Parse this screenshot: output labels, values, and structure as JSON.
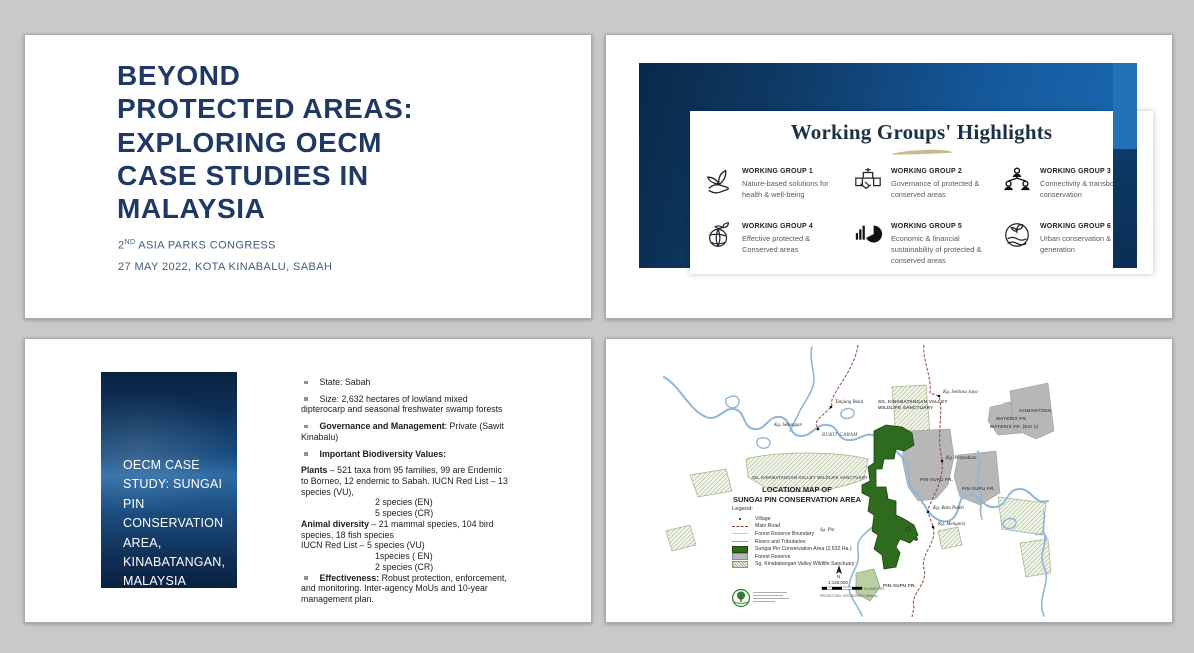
{
  "colors": {
    "canvas_bg": "#c9c9c9",
    "title_navy": "#1F3864",
    "subtitle_steel": "#3E5E7E",
    "frame_blue_dark": "#0a2948",
    "frame_blue_light": "#1a6cb4",
    "gold": "#C9BB8B",
    "map_green": "#2e6b1e",
    "map_gray": "#b7b7b7",
    "river_blue": "#8fb6d6",
    "road_brown": "#8a4a38"
  },
  "slide1": {
    "title": "BEYOND\nPROTECTED AREAS:\nEXPLORING OECM\nCASE STUDIES IN\nMALAYSIA",
    "congress_prefix": "2",
    "congress_sup": "ND",
    "congress_rest": " ASIA PARKS CONGRESS",
    "date_line": "27 MAY 2022, KOTA KINABALU, SABAH"
  },
  "slide2": {
    "title": "Working Groups' Highlights",
    "groups": [
      {
        "num": "WORKING GROUP 1",
        "desc": "Nature-based solutions for health & well-being",
        "icon": "hand-seedling-icon"
      },
      {
        "num": "WORKING GROUP 2",
        "desc": "Governance of protected & conserved areas",
        "icon": "handshake-building-icon"
      },
      {
        "num": "WORKING GROUP 3",
        "desc": "Connectivity & transboundary conservation",
        "icon": "people-network-icon"
      },
      {
        "num": "WORKING GROUP 4",
        "desc": "Effective protected & Conserved areas",
        "icon": "globe-sprout-icon"
      },
      {
        "num": "WORKING GROUP 5",
        "desc": "Economic & financial sustainability of protected & conserved areas",
        "icon": "bar-pie-chart-icon"
      },
      {
        "num": "WORKING GROUP 6",
        "desc": "Urban conservation & a new generation",
        "icon": "field-sprout-icon"
      }
    ]
  },
  "slide3": {
    "panel_title": "OECM CASE\nSTUDY: SUNGAI\nPIN\nCONSERVATION\nAREA,\nKINABATANGAN,\nMALAYSIA",
    "items": [
      {
        "type": "bullet",
        "parts": [
          {
            "t": "State: Sabah"
          }
        ]
      },
      {
        "type": "bullet",
        "parts": [
          {
            "t": "Size: 2,632 hectares of lowland mixed dipterocarp and seasonal freshwater swamp forests"
          }
        ]
      },
      {
        "type": "bullet",
        "parts": [
          {
            "t": "Governance and Management",
            "b": true
          },
          {
            "t": ": Private (Sawit Kinabalu)"
          }
        ]
      },
      {
        "type": "bullet",
        "parts": [
          {
            "t": "Important Biodiversity Values:",
            "b": true
          }
        ]
      },
      {
        "type": "para",
        "parts": [
          {
            "t": "Plants",
            "b": true
          },
          {
            "t": " – 521 taxa from 95 families, 99 are Endemic to Borneo, 12 endemic to Sabah. IUCN Red List – 13 species (VU),"
          }
        ]
      },
      {
        "type": "indent",
        "parts": [
          {
            "t": "2 species (EN)"
          }
        ]
      },
      {
        "type": "indent",
        "parts": [
          {
            "t": "5 species (CR)"
          }
        ]
      },
      {
        "type": "para",
        "parts": [
          {
            "t": "Animal diversity",
            "b": true
          },
          {
            "t": " – 21 mammal species, 104 bird species, 18 fish species"
          }
        ]
      },
      {
        "type": "para",
        "parts": [
          {
            "t": "IUCN Red List  – 5 species (VU)"
          }
        ]
      },
      {
        "type": "indent",
        "parts": [
          {
            "t": "1species ( EN)"
          }
        ]
      },
      {
        "type": "indent",
        "parts": [
          {
            "t": "2 species (CR)"
          }
        ]
      },
      {
        "type": "bullet",
        "parts": [
          {
            "t": "Effectiveness:",
            "b": true
          },
          {
            "t": " Robust protection, enforcement, and monitoring. Inter-agency MoUs and 10-year management plan."
          }
        ]
      }
    ]
  },
  "slide4": {
    "map_title": "LOCATION MAP OF\nSUNGAI PIN CONSERVATION AREA",
    "legend_header": "Legend:",
    "legend": [
      {
        "swatch": "dot",
        "label": "Village"
      },
      {
        "swatch": "road",
        "label": "Main Road"
      },
      {
        "swatch": "boundary",
        "label": "Forest Reserve Boundary"
      },
      {
        "swatch": "river",
        "label": "Rivers and Tributaries"
      },
      {
        "swatch": "green",
        "label": "Sungai Pin Conservation Area (2,632 Ha.)"
      },
      {
        "swatch": "gray",
        "label": "Forest Reserve"
      },
      {
        "swatch": "hatch",
        "label": "Sg. Kinabatangan Valley Wildlife Sanctuary"
      }
    ],
    "labels": [
      {
        "t": "Kg. Sentosa Jaya",
        "x": 337,
        "y": 51,
        "cls": "v"
      },
      {
        "t": "Tanjung Bulat",
        "x": 229,
        "y": 61,
        "cls": "v"
      },
      {
        "t": "Kg. Sebongan",
        "x": 168,
        "y": 84,
        "cls": "v"
      },
      {
        "t": "BUKIT GARAM",
        "x": 216,
        "y": 94,
        "cls": "it"
      },
      {
        "t": "Kg. Perpaduan",
        "x": 340,
        "y": 117,
        "cls": "v"
      },
      {
        "t": "Kg. Batu Puteh",
        "x": 327,
        "y": 167,
        "cls": "v"
      },
      {
        "t": "Kg. Mengaris",
        "x": 332,
        "y": 183,
        "cls": "v"
      },
      {
        "t": "Sg. Pin",
        "x": 214,
        "y": 189,
        "cls": "v"
      },
      {
        "t": "SG. KINABATANGAN VALLEY",
        "x": 272,
        "y": 60,
        "cls": "fr"
      },
      {
        "t": "WILDLIFE SANCTUARY",
        "x": 272,
        "y": 66,
        "cls": "fr"
      },
      {
        "t": "SG. KINABATANGAN VALLEY WILDLIFE SANCTUARY",
        "x": 146,
        "y": 136,
        "cls": "frs"
      },
      {
        "t": "MATERIS FR.",
        "x": 390,
        "y": 77,
        "cls": "fr"
      },
      {
        "t": "MATERIS FR. (Ext 1)",
        "x": 384,
        "y": 85,
        "cls": "fr"
      },
      {
        "t": "GOMANTONG",
        "x": 413,
        "y": 69,
        "cls": "fr"
      },
      {
        "t": "PIN-SUPU FR.",
        "x": 314,
        "y": 138,
        "cls": "fr"
      },
      {
        "t": "PIN-SUPU FR.",
        "x": 356,
        "y": 147,
        "cls": "fr"
      },
      {
        "t": "PIN-SUPU FR.",
        "x": 277,
        "y": 244,
        "cls": "fr"
      },
      {
        "t": "N",
        "x": 231,
        "y": 235,
        "cls": "sc"
      },
      {
        "t": "1:140,000",
        "x": 222,
        "y": 241,
        "cls": "sc"
      },
      {
        "t": "KILOMETERS",
        "x": 258,
        "y": 248,
        "cls": "tiny"
      },
      {
        "t": "PROJECTION : RSO BORNEO (Meters)",
        "x": 214,
        "y": 255,
        "cls": "tiny"
      }
    ]
  }
}
